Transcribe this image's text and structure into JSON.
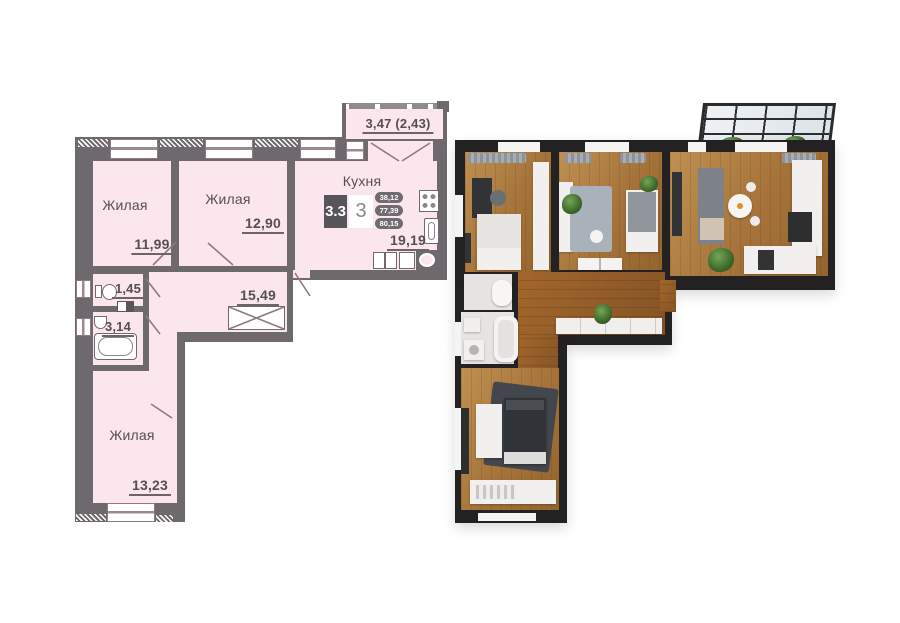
{
  "plan_2d": {
    "rooms": {
      "living_1": {
        "label": "Жилая",
        "area": "11,99"
      },
      "living_2": {
        "label": "Жилая",
        "area": "12,90"
      },
      "kitchen": {
        "label": "Кухня",
        "area": "19,19"
      },
      "wc": {
        "area": "1,45"
      },
      "bathroom": {
        "area": "3,14"
      },
      "hallway": {
        "area": "15,49"
      },
      "living_3": {
        "label": "Жилая",
        "area": "13,23"
      },
      "balcony": {
        "area": "3,47 (2,43)"
      }
    },
    "info_badge": {
      "plan_type": "3.3",
      "rooms_count": "3",
      "areas": {
        "living": "38,12",
        "without_balcony": "77,39",
        "total": "80,15"
      }
    },
    "icons": {
      "toilet": "css-shape",
      "bathtub": "css-shape",
      "sink": "css-shape",
      "stove": "css-dots",
      "wardrobe": "x-cross",
      "ventilation": "css-shape"
    },
    "colors": {
      "room_fill": "#fce6ee",
      "wall": "#6e696c",
      "outline": "#8d7a83",
      "badge_dark": "#57555a",
      "badge_pill": "#6f6b6f"
    }
  },
  "plan_3d": {
    "colors": {
      "wall": "#242122",
      "wood_floor": "#a5733a",
      "hall_floor": "#8a5a28",
      "rug": "#a9b2ba",
      "plant": "#3a6428",
      "glass_frame": "#2c2a2a"
    }
  }
}
